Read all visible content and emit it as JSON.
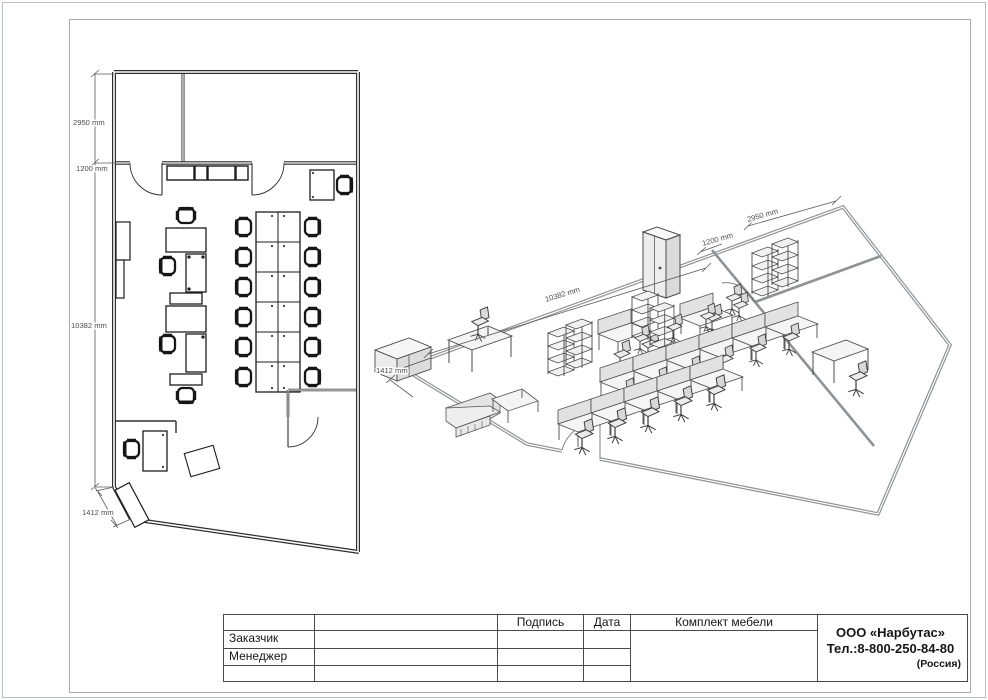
{
  "page": {
    "background": "#ffffff",
    "frame_color": "#a7adb0",
    "wall_color_2d": "#2e2e2e",
    "wall_color_3d": "#8d9396"
  },
  "plan_2d": {
    "name": "office floor plan top view",
    "dimensions": {
      "top_room_depth": "2950 mm",
      "wall_offset": "1200 mm",
      "room_length": "10382 mm",
      "corner_wall": "1412 mm"
    }
  },
  "view_3d": {
    "name": "office furniture isometric view",
    "dimensions": {
      "room_length": "10382 mm",
      "top_room_depth": "2950 mm",
      "wall_offset": "1200 mm",
      "corner_wall": "1412 mm"
    }
  },
  "title_block": {
    "col_signature": "Подпись",
    "col_date": "Дата",
    "col_set": "Комплект мебели",
    "row_customer": "Заказчик",
    "row_manager": "Менеджер",
    "company": {
      "name": "ООО «Нарбутас»",
      "phone": "Тел.:8-800-250-84-80",
      "country": "(Россия)"
    }
  }
}
